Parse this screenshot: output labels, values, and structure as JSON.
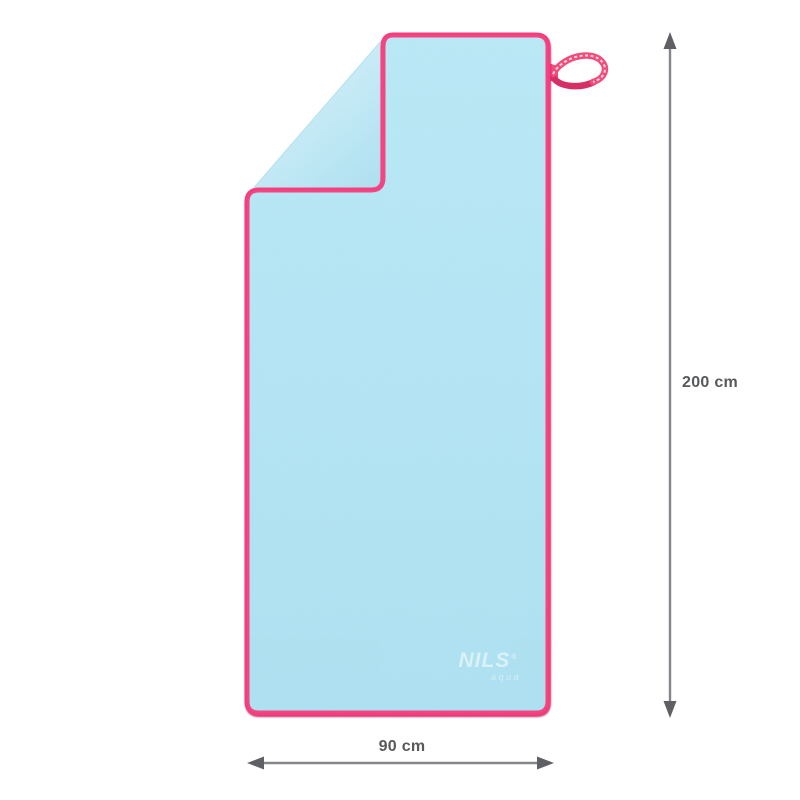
{
  "product": {
    "brand": {
      "name": "NILS",
      "registered_mark": "®",
      "sub_brand": "aqua"
    },
    "dimensions": {
      "height_label": "200 cm",
      "width_label": "90 cm"
    }
  },
  "colors": {
    "towel_main_top": "#b7e7f5",
    "towel_main_bottom": "#aadff0",
    "towel_fold_light": "#d2f0fa",
    "towel_fold_dark": "#abdfef",
    "crease_edge": "#9fd8ea",
    "border_pink": "#f33e7c",
    "border_shadow": "#c9145a",
    "ribbon_pink": "#ef4d7c",
    "ribbon_dark": "#d62f66",
    "ribbon_text_white": "#ffffff",
    "arrow_line": "#85868a",
    "arrow_head": "#5f6066",
    "label_text": "#58595b"
  }
}
